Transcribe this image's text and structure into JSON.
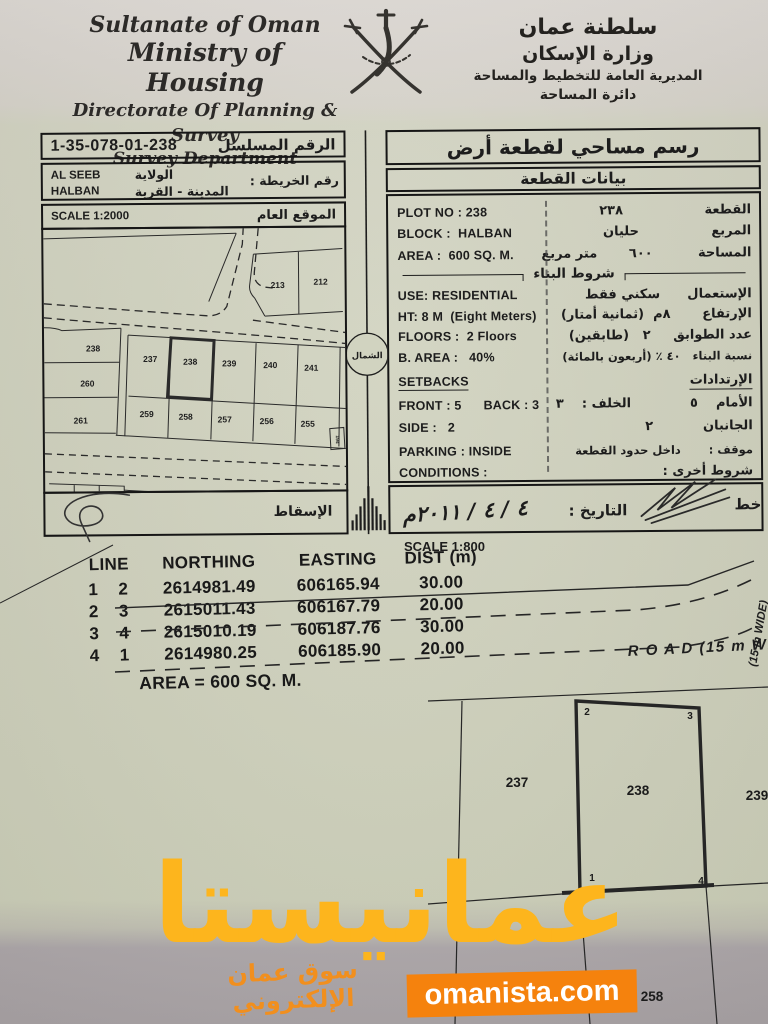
{
  "header": {
    "en_lines": [
      "Sultanate of Oman",
      "Ministry of Housing",
      "Directorate Of Planning & Survey",
      "Survey Department"
    ],
    "ar_lines": [
      "سلطنة عمان",
      "وزارة الإسكان",
      "المديرية العامة للتخطيط والمساحة",
      "دائرة المساحة"
    ],
    "emblem": "oman-national-emblem"
  },
  "serial": {
    "value": "1-35-078-01-238",
    "label_ar": "الرقم المسلسل"
  },
  "location": {
    "wilaya_value": "AL SEEB",
    "town_value": "HALBAN",
    "wilaya_label_ar": "الولاية",
    "town_label_ar": "المدينة - القرية",
    "map_no_label_ar": "رقم الخريطة :"
  },
  "general_site": {
    "scale_en": "SCALE 1:2000",
    "label_ar": "الموقع العام"
  },
  "projection_label_ar": "الإسقاط",
  "north_label_ar": "الشمال",
  "site_map": {
    "plots": [
      "213",
      "212",
      "238",
      "237",
      "238",
      "239",
      "240",
      "241",
      "260",
      "261",
      "259",
      "258",
      "257",
      "256",
      "255"
    ],
    "utility_box": "194"
  },
  "plot_card": {
    "title_ar": "رسم مساحي لقطعة أرض",
    "subtitle_ar": "بيانات القطعة",
    "plot_no_en": "PLOT NO : 238",
    "plot_no_ar": "القطعة                  ٢٣٨",
    "block_en": "BLOCK :  HALBAN",
    "block_ar": "المربع                حليان",
    "area_en": "AREA :  600 SQ. M.",
    "area_ar": "المساحة          ٦٠٠       متر مربع",
    "building_header_ar": "شروط البناء",
    "use_en": "USE: RESIDENTIAL",
    "use_ar": "الإستعمال      سكني فقط",
    "height_en": "HT: 8 M  (Eight Meters)",
    "height_ar": "الإرتفاع       ٨م  (ثمانية أمتار)",
    "floors_en": "FLOORS :  2 Floors",
    "floors_ar": "عدد الطوابق     ٢   (طابقين)",
    "barea_en": "B. AREA :   40%",
    "barea_ar": "نسبة البناء   ٤٠ ٪ (أربعون بالمائة)",
    "setbacks_en": "SETBACKS",
    "setbacks_ar": "الإرتدادات",
    "front_back_en": "FRONT : 5      BACK : 3",
    "front_back_ar": "الأمام    ٥             الخلف :    ٣",
    "side_en": "SIDE :   2",
    "side_ar": "الجانبان           ٢",
    "parking_en": "PARKING : INSIDE",
    "parking_ar": "موقف :       داخل حدود القطعة",
    "conditions_en": "CONDITIONS :",
    "conditions_ar": "شروط أخرى :",
    "date_label_ar": "التاريخ :",
    "date_value": "٤ / ٤ / ٢٠١١م",
    "planner_fragment_ar": "خط"
  },
  "survey": {
    "scale_en": "SCALE 1:800",
    "table": {
      "col_line": "LINE",
      "col_northing": "NORTHING",
      "col_easting": "EASTING",
      "col_dist": "DIST (m)",
      "rows": [
        [
          "1",
          "2",
          "2614981.49",
          "606165.94",
          "30.00"
        ],
        [
          "2",
          "3",
          "2615011.43",
          "606167.79",
          "20.00"
        ],
        [
          "3",
          "4",
          "2615010.19",
          "606187.76",
          "30.00"
        ],
        [
          "4",
          "1",
          "2614980.25",
          "606185.90",
          "20.00"
        ]
      ],
      "area_note": "AREA = 600 SQ. M."
    },
    "road_label": "R O A D  (15 m WIDE)",
    "road_label_side": "(15 m WIDE)",
    "detail_plots": [
      "237",
      "238",
      "239",
      "258"
    ],
    "corners": [
      "1",
      "2",
      "3",
      "4"
    ]
  },
  "watermark": {
    "main_ar": "عمانيستا",
    "tagline_ar": "سوق عمان الإلكتروني",
    "site": "omanista.com",
    "yellow": "#fdb51d",
    "orange": "#f5820d",
    "tagline_orange": "#f18f1e"
  }
}
